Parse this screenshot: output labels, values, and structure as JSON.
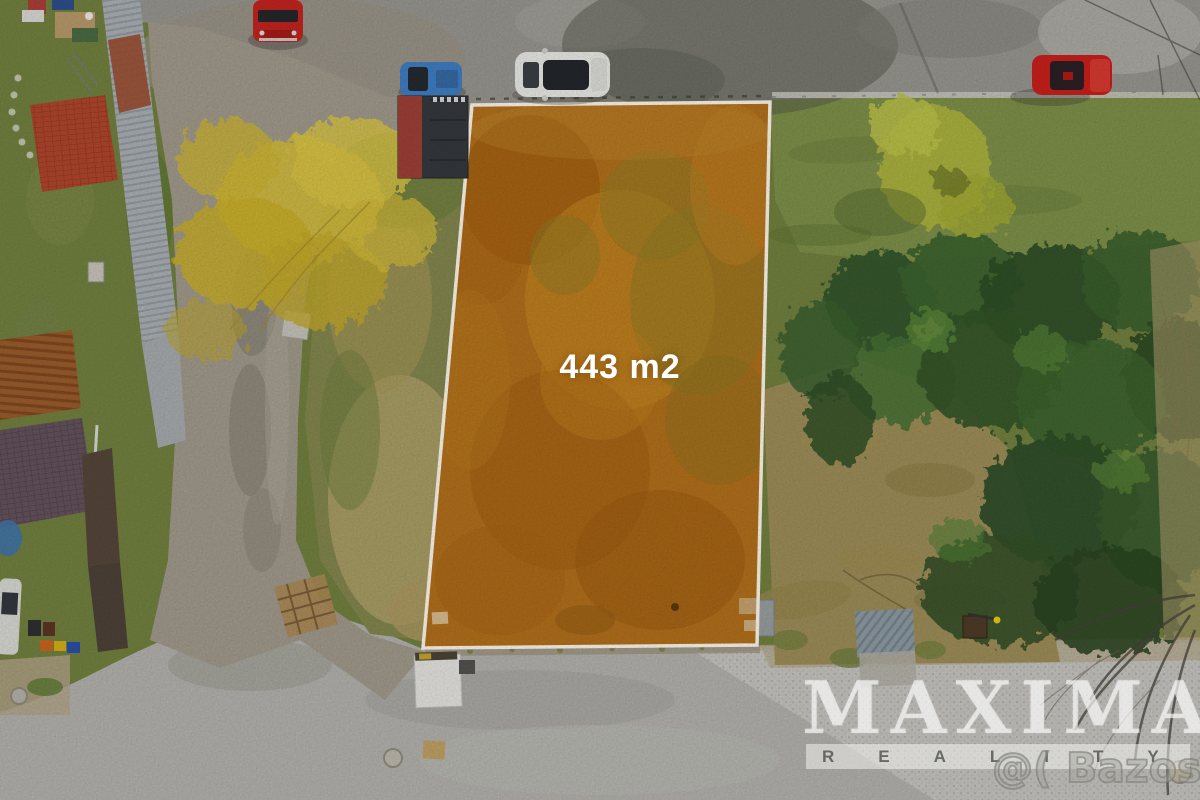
{
  "plot_overlay": {
    "area_label": "443 m2",
    "fill_color": "#b2701c",
    "border_color": "#fdf6ea"
  },
  "watermarks": {
    "agency": "MAXIMA",
    "agency_sub": "REALITY",
    "listing_site": "@( Bazos.cz"
  },
  "scene": {
    "type": "aerial-drone-photo",
    "vehicles": [
      {
        "name": "red-van-top-left",
        "color": "#c32420"
      },
      {
        "name": "blue-car",
        "color": "#3f7ec2"
      },
      {
        "name": "white-car",
        "color": "#e9e9e5"
      },
      {
        "name": "red-car-top-right",
        "color": "#c9201b"
      }
    ],
    "terrain_colors": {
      "asphalt_road": "#98968f",
      "concrete_road": "#b3b2ad",
      "grass": "#72813f",
      "dry_grass": "#9d8d58",
      "pine_trees": "#2f4f27",
      "yellow_tree": "#d2bc3e"
    }
  }
}
